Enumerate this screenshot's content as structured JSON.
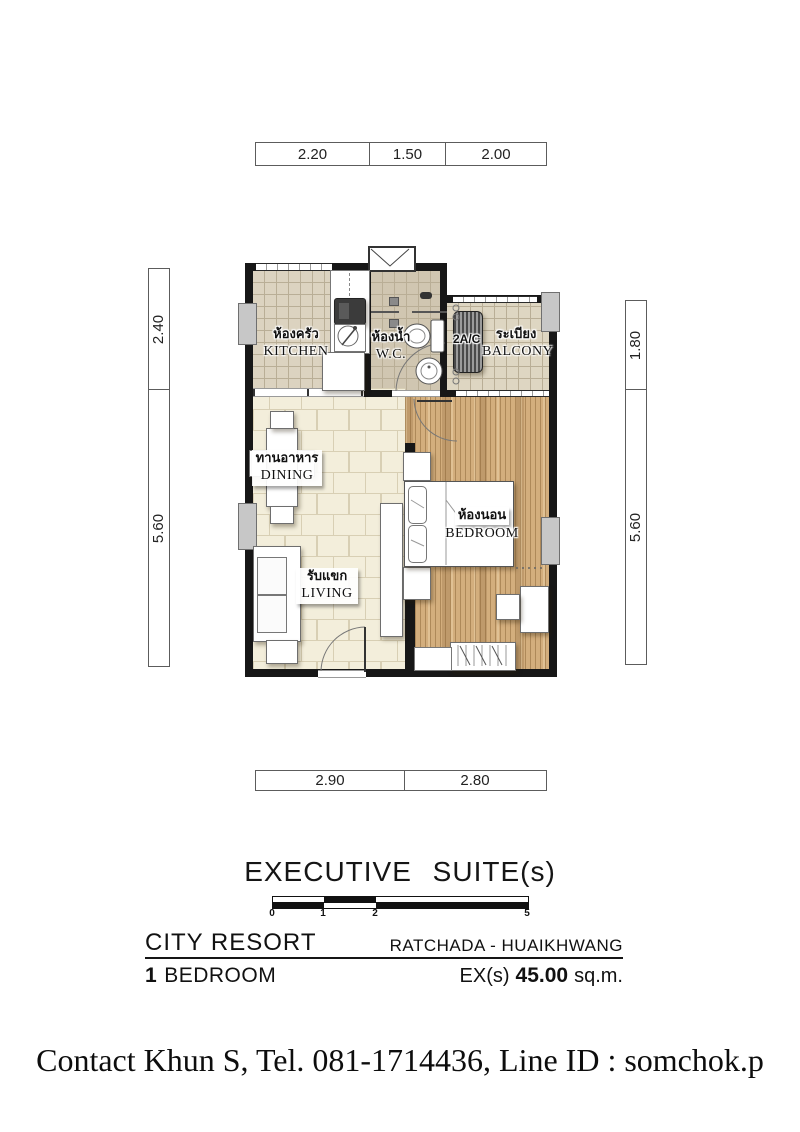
{
  "plan": {
    "rooms": {
      "kitchen": {
        "thai": "ห้องครัว",
        "en": "KITCHEN"
      },
      "wc": {
        "thai": "ห้องน้ำ",
        "en": "W.C."
      },
      "balcony": {
        "thai": "ระเบียง",
        "en": "BALCONY"
      },
      "dining": {
        "thai": "ทานอาหาร",
        "en": "DINING"
      },
      "living": {
        "thai": "รับแขก",
        "en": "LIVING"
      },
      "bedroom": {
        "thai": "ห้องนอน",
        "en": "BEDROOM"
      }
    },
    "ac_unit_label": "2A/C"
  },
  "dimensions": {
    "top": [
      "2.20",
      "1.50",
      "2.00"
    ],
    "left": [
      "2.40",
      "5.60"
    ],
    "right": [
      "1.80",
      "5.60"
    ],
    "bottom": [
      "2.90",
      "2.80"
    ]
  },
  "scale_bar": {
    "labels": [
      "0",
      "1",
      "2",
      "5"
    ]
  },
  "title_block": {
    "plan_title": "EXECUTIVE SUITE(s)",
    "project_name": "CITY RESORT",
    "location": "RATCHADA - HUAIKHWANG",
    "unit_count": "1",
    "unit_type": "BEDROOM",
    "area_prefix": "EX(s)",
    "area_value": "45.00",
    "area_unit": "sq.m."
  },
  "footer": {
    "contact_line": "Contact Khun S, Tel. 081-1714436, Line ID : somchok.p"
  },
  "colors": {
    "wall": "#171717",
    "wood_floor": "#d3ae7d",
    "tile_cream": "#f3eedb",
    "tile_kitchen": "#dcd3c0",
    "tile_wc": "#d0c6b1",
    "tile_balcony": "#ded6c2"
  }
}
